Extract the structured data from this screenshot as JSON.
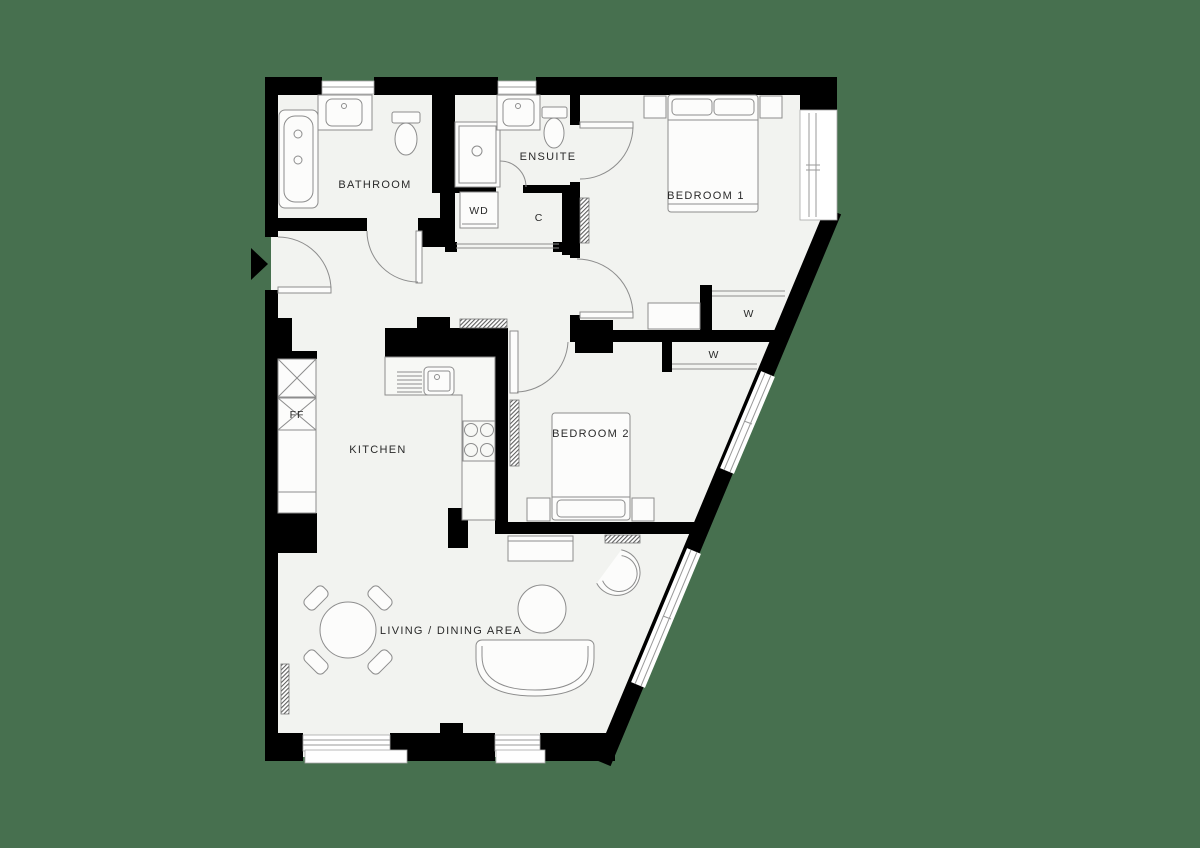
{
  "canvas": {
    "width": 1200,
    "height": 848,
    "background_color": "#47704F"
  },
  "palette": {
    "floor": "#F2F3F0",
    "wall": "#000000",
    "furniture_line": "#8D8D8D",
    "glass_line": "#9A9A9A",
    "label_color": "#2A2A2A"
  },
  "labels": {
    "bathroom": "BATHROOM",
    "ensuite": "ENSUITE",
    "wd": "WD",
    "cupboard": "C",
    "bedroom1": "BEDROOM 1",
    "bedroom1_wardrobe": "W",
    "bedroom2": "BEDROOM 2",
    "bedroom2_wardrobe": "W",
    "kitchen": "KITCHEN",
    "fridge_freezer": "FF",
    "living_dining": "LIVING / DINING AREA"
  },
  "fixtures": [
    "entrance-arrow",
    "entry-door-swing",
    "bathtub",
    "washbasin",
    "toilet",
    "shower-enclosure",
    "shower-door-swing",
    "wd-appliance-cupboard",
    "storage-cupboard-sliding-door",
    "double-bed",
    "bedside-table",
    "wardrobe-sliding-door",
    "dresser",
    "radiator",
    "kitchen-counter",
    "kitchen-sink",
    "hob",
    "tall-unit",
    "fridge-freezer-unit",
    "dining-table",
    "dining-chair",
    "coffee-table",
    "curved-sofa",
    "armchair",
    "tv-unit",
    "window",
    "diagonal-window"
  ]
}
